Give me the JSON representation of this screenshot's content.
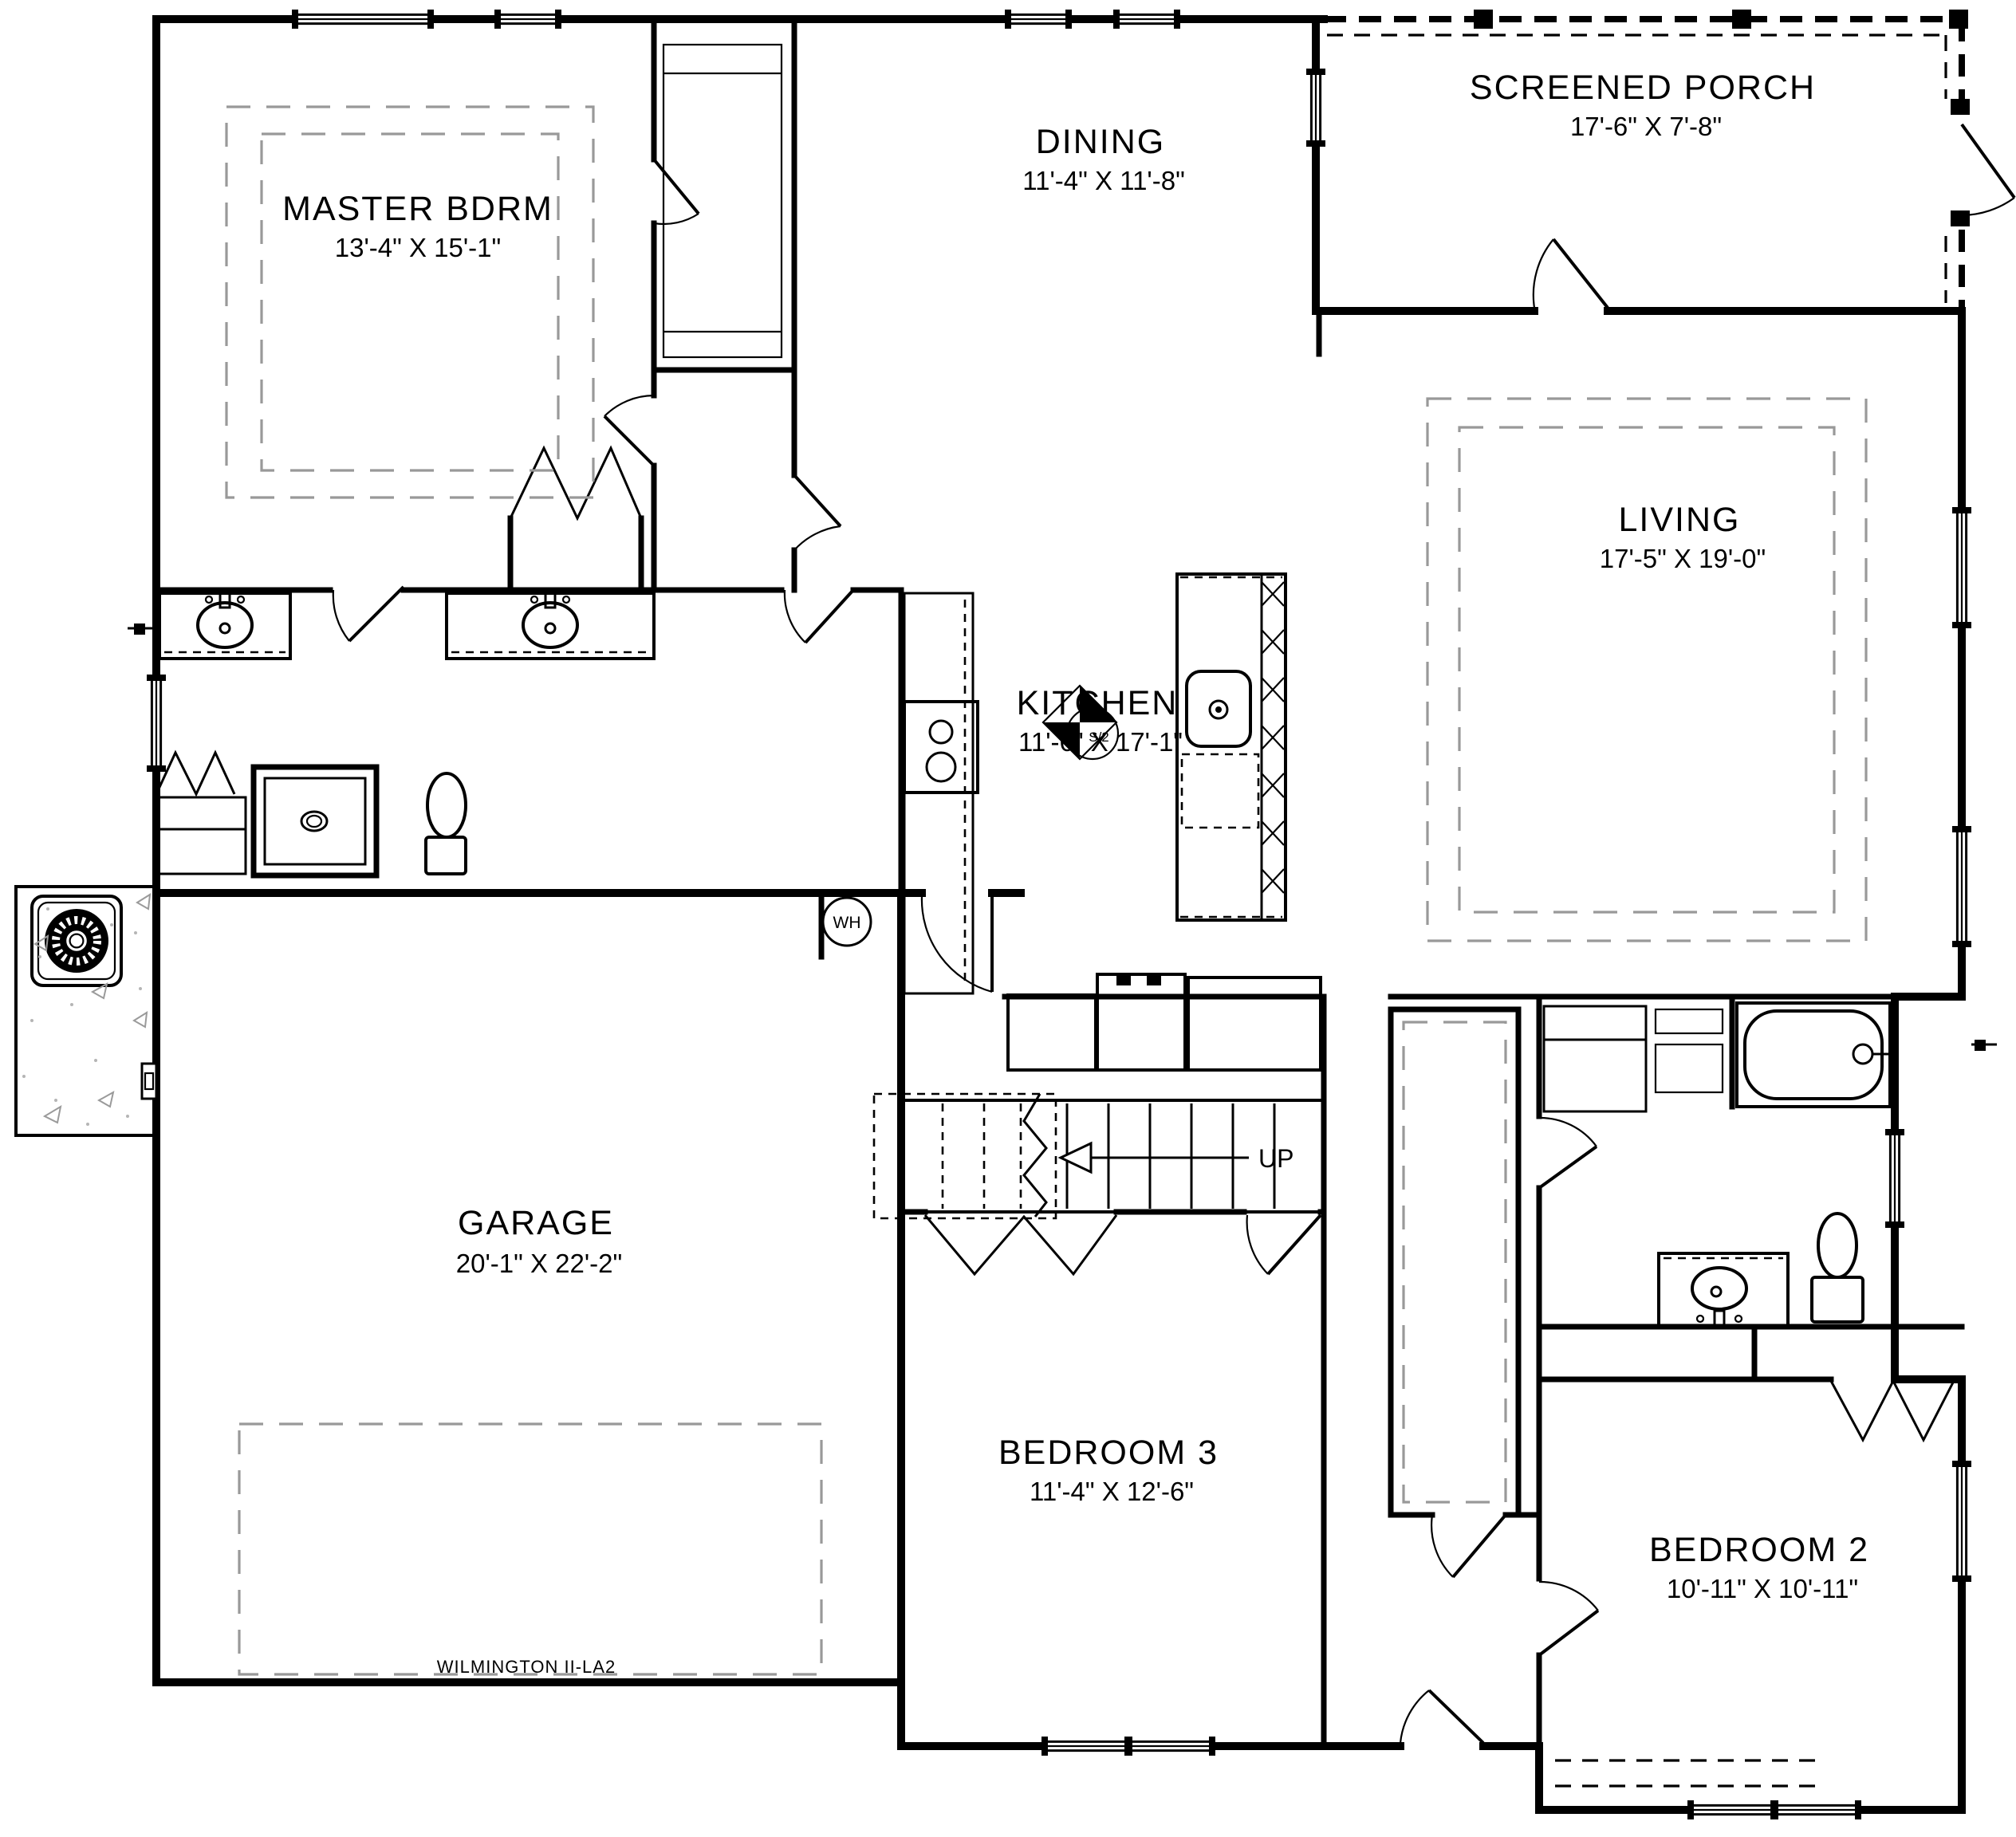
{
  "plan": {
    "title": "WILMINGTON II-LA2"
  },
  "rooms": {
    "master": {
      "name": "MASTER BDRM",
      "dims": "13'-4\" X 15'-1\""
    },
    "dining": {
      "name": "DINING",
      "dims": "11'-4\" X 11'-8\""
    },
    "porch": {
      "name": "SCREENED PORCH",
      "dims": "17'-6\" X 7'-8\""
    },
    "living": {
      "name": "LIVING",
      "dims": "17'-5\" X 19'-0\""
    },
    "kitchen": {
      "name": "KITCHEN",
      "dims": "11'-6\" X 17'-1\""
    },
    "garage": {
      "name": "GARAGE",
      "dims": "20'-1\" X 22'-2\""
    },
    "bedroom3": {
      "name": "BEDROOM 3",
      "dims": "11'-4\" X 12'-6\""
    },
    "bedroom2": {
      "name": "BEDROOM 2",
      "dims": "10'-11\" X 10'-11\""
    }
  },
  "annotations": {
    "stairs_up": "UP",
    "water_heater": "WH",
    "fan_symbol": "S/2"
  }
}
